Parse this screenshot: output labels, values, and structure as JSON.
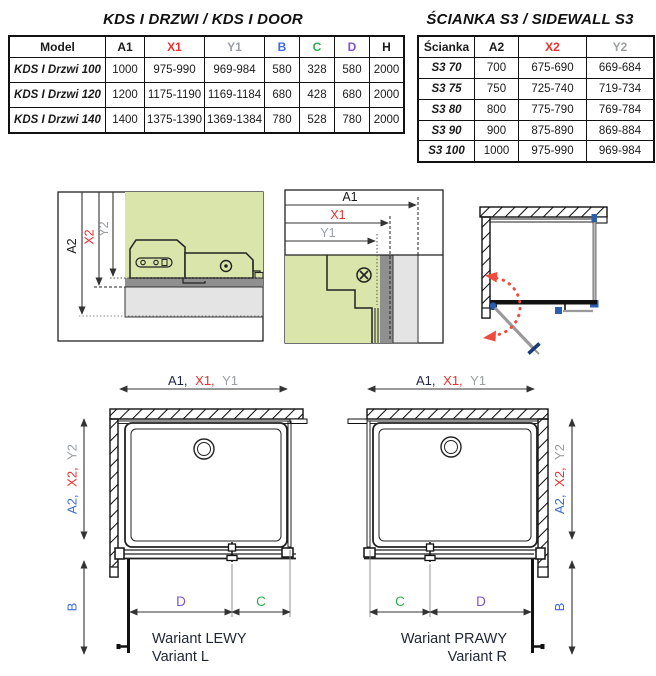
{
  "colors": {
    "black": "#1a1a1a",
    "navy": "#1e2446",
    "red": "#e8312e",
    "gray": "#9a9fa5",
    "blue": "#3c6bd9",
    "green": "#2fae4a",
    "purple": "#7d55d2",
    "glass_green": "#d9e5ab",
    "hardware_blue": "#2b5fad",
    "swing_red": "#ef4b3f"
  },
  "door_table": {
    "title": "KDS I DRZWI / KDS I DOOR",
    "headers": [
      {
        "label": "Model",
        "color": "#1a1a1a"
      },
      {
        "label": "A1",
        "color": "#1a1a1a"
      },
      {
        "label": "X1",
        "color": "#e8312e"
      },
      {
        "label": "Y1",
        "color": "#9a9fa5"
      },
      {
        "label": "B",
        "color": "#3c6bd9"
      },
      {
        "label": "C",
        "color": "#2fae4a"
      },
      {
        "label": "D",
        "color": "#7d55d2"
      },
      {
        "label": "H",
        "color": "#1a1a1a"
      }
    ],
    "rows": [
      [
        "KDS I Drzwi 100",
        "1000",
        "975-990",
        "969-984",
        "580",
        "328",
        "580",
        "2000"
      ],
      [
        "KDS I Drzwi 120",
        "1200",
        "1175-1190",
        "1169-1184",
        "680",
        "428",
        "680",
        "2000"
      ],
      [
        "KDS I Drzwi 140",
        "1400",
        "1375-1390",
        "1369-1384",
        "780",
        "528",
        "780",
        "2000"
      ]
    ]
  },
  "sidewall_table": {
    "title": "ŚCIANKA S3 / SIDEWALL S3",
    "headers": [
      {
        "label": "Ścianka",
        "color": "#1a1a1a"
      },
      {
        "label": "A2",
        "color": "#1a1a1a"
      },
      {
        "label": "X2",
        "color": "#e8312e"
      },
      {
        "label": "Y2",
        "color": "#9a9fa5"
      }
    ],
    "rows": [
      [
        "S3 70",
        "700",
        "675-690",
        "669-684"
      ],
      [
        "S3 75",
        "750",
        "725-740",
        "719-734"
      ],
      [
        "S3 80",
        "800",
        "775-790",
        "769-784"
      ],
      [
        "S3 90",
        "900",
        "875-890",
        "869-884"
      ],
      [
        "S3 100",
        "1000",
        "975-990",
        "969-984"
      ]
    ]
  },
  "section_sidewall": {
    "a2": "A2",
    "x2": "X2",
    "y2": "Y2"
  },
  "section_door": {
    "a1": "A1",
    "x1": "X1",
    "y1": "Y1"
  },
  "variant_left": {
    "top_a1": "A1,",
    "top_x1": "X1,",
    "top_y1": "Y1",
    "side_a2": "A2,",
    "side_x2": "X2,",
    "side_y2": "Y2",
    "b": "B",
    "d": "D",
    "c": "C",
    "caption_pl": "Wariant LEWY",
    "caption_en": "Variant L"
  },
  "variant_right": {
    "top_a1": "A1,",
    "top_x1": "X1,",
    "top_y1": "Y1",
    "side_a2": "A2,",
    "side_x2": "X2,",
    "side_y2": "Y2",
    "b": "B",
    "c": "C",
    "d": "D",
    "caption_pl": "Wariant PRAWY",
    "caption_en": "Variant R"
  }
}
